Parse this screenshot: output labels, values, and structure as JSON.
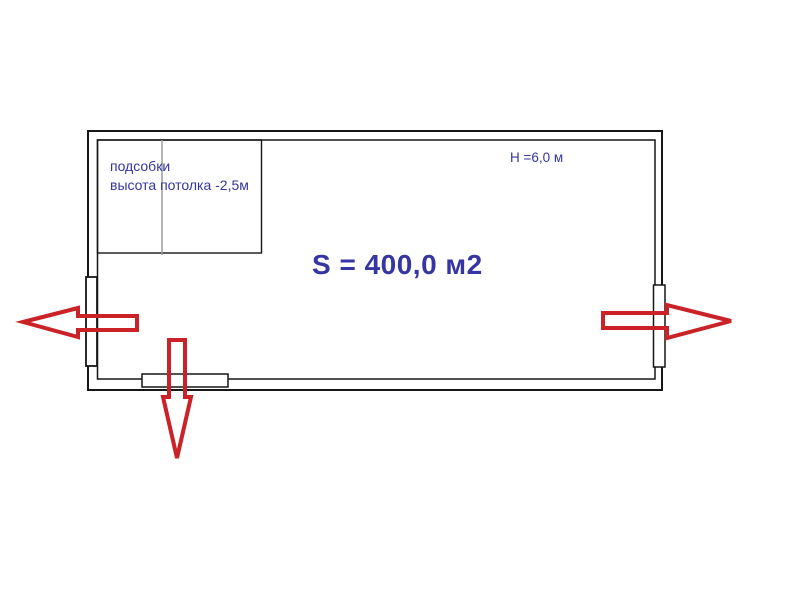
{
  "diagram": {
    "title": "floor-plan",
    "annex": {
      "name": "подсобки",
      "ceiling_note": "высота потолка -2,5м"
    },
    "hall": {
      "height_label": "H =6,0 м",
      "area_label": "S = 400,0 м2"
    },
    "exits": [
      {
        "name": "exit-arrow-left",
        "direction": "left"
      },
      {
        "name": "exit-arrow-right",
        "direction": "right"
      },
      {
        "name": "exit-arrow-down",
        "direction": "down"
      }
    ],
    "colors": {
      "text_blue": "#3535a3",
      "arrow_red": "#cb2227",
      "wall_black": "#161616",
      "divider_gray": "#9a9a9a",
      "background": "#ffffff"
    }
  }
}
